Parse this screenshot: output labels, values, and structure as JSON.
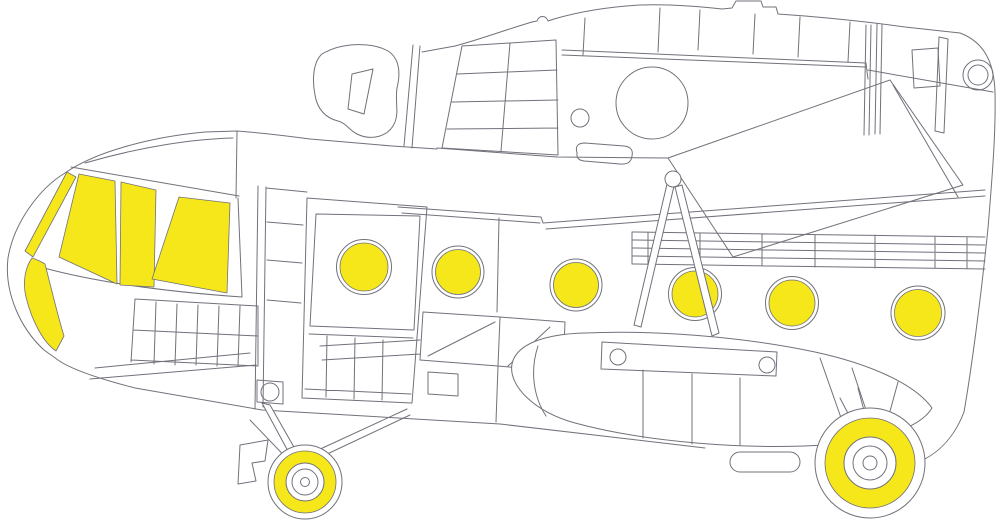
{
  "description": "Side-profile line drawing of a Mi-8/Mi-17 helicopter fuselage with yellow paint-masking areas covering the cockpit glazing, six circular cabin portholes, and both landing-gear wheel hubs",
  "colors": {
    "background": "#ffffff",
    "line": "#71717b",
    "mask_yellow": "#f6e71a"
  },
  "counts": {
    "cockpit_masks": 5,
    "porthole_masks": 6,
    "wheel_masks": 2
  },
  "masks": {
    "cockpit": [
      {
        "name": "windshield-edge-strip-mask",
        "path": "M67,172 L76,177 L33,257 L25,251 Z"
      },
      {
        "name": "windshield-panel-left-mask",
        "path": "M79,174 L115,181 L117,284 L59,257 Z"
      },
      {
        "name": "windshield-panel-middle-mask",
        "path": "M121,182 L156,190 L154,287 L120,285 Z"
      },
      {
        "name": "windshield-panel-right-mask",
        "path": "M179,197 L230,203 L227,293 L152,279 Z"
      },
      {
        "name": "chin-window-mask",
        "path": "M32,258 C38,260 42,262 45,264 C52,291 58,317 64,336 L56,351 C44,343 32,322 26,297 C22,281 26,266 32,258 Z"
      }
    ],
    "portholes": [
      {
        "name": "porthole-mask-1",
        "cx": 364,
        "cy": 267,
        "r_mask": 24,
        "r_ring": 27.5
      },
      {
        "name": "porthole-mask-2",
        "cx": 458,
        "cy": 272,
        "r_mask": 22.5,
        "r_ring": 26
      },
      {
        "name": "porthole-mask-3",
        "cx": 576,
        "cy": 285,
        "r_mask": 22.5,
        "r_ring": 26
      },
      {
        "name": "porthole-mask-4",
        "cx": 695,
        "cy": 294,
        "r_mask": 23,
        "r_ring": 26.5
      },
      {
        "name": "porthole-mask-5",
        "cx": 792,
        "cy": 303,
        "r_mask": 23,
        "r_ring": 26.5
      },
      {
        "name": "porthole-mask-6",
        "cx": 918,
        "cy": 313,
        "r_mask": 23.5,
        "r_ring": 27
      }
    ],
    "wheels": [
      {
        "name": "nose-wheel-mask",
        "cx": 305,
        "cy": 482,
        "r_tire": 37,
        "ring_outer": 31,
        "ring_inner": 19,
        "hub_rings": [
          13,
          4.5
        ]
      },
      {
        "name": "main-wheel-mask",
        "cx": 870,
        "cy": 463,
        "r_tire": 55,
        "ring_outer": 45,
        "ring_inner": 26,
        "hub_rings": [
          17,
          7
        ]
      }
    ]
  }
}
